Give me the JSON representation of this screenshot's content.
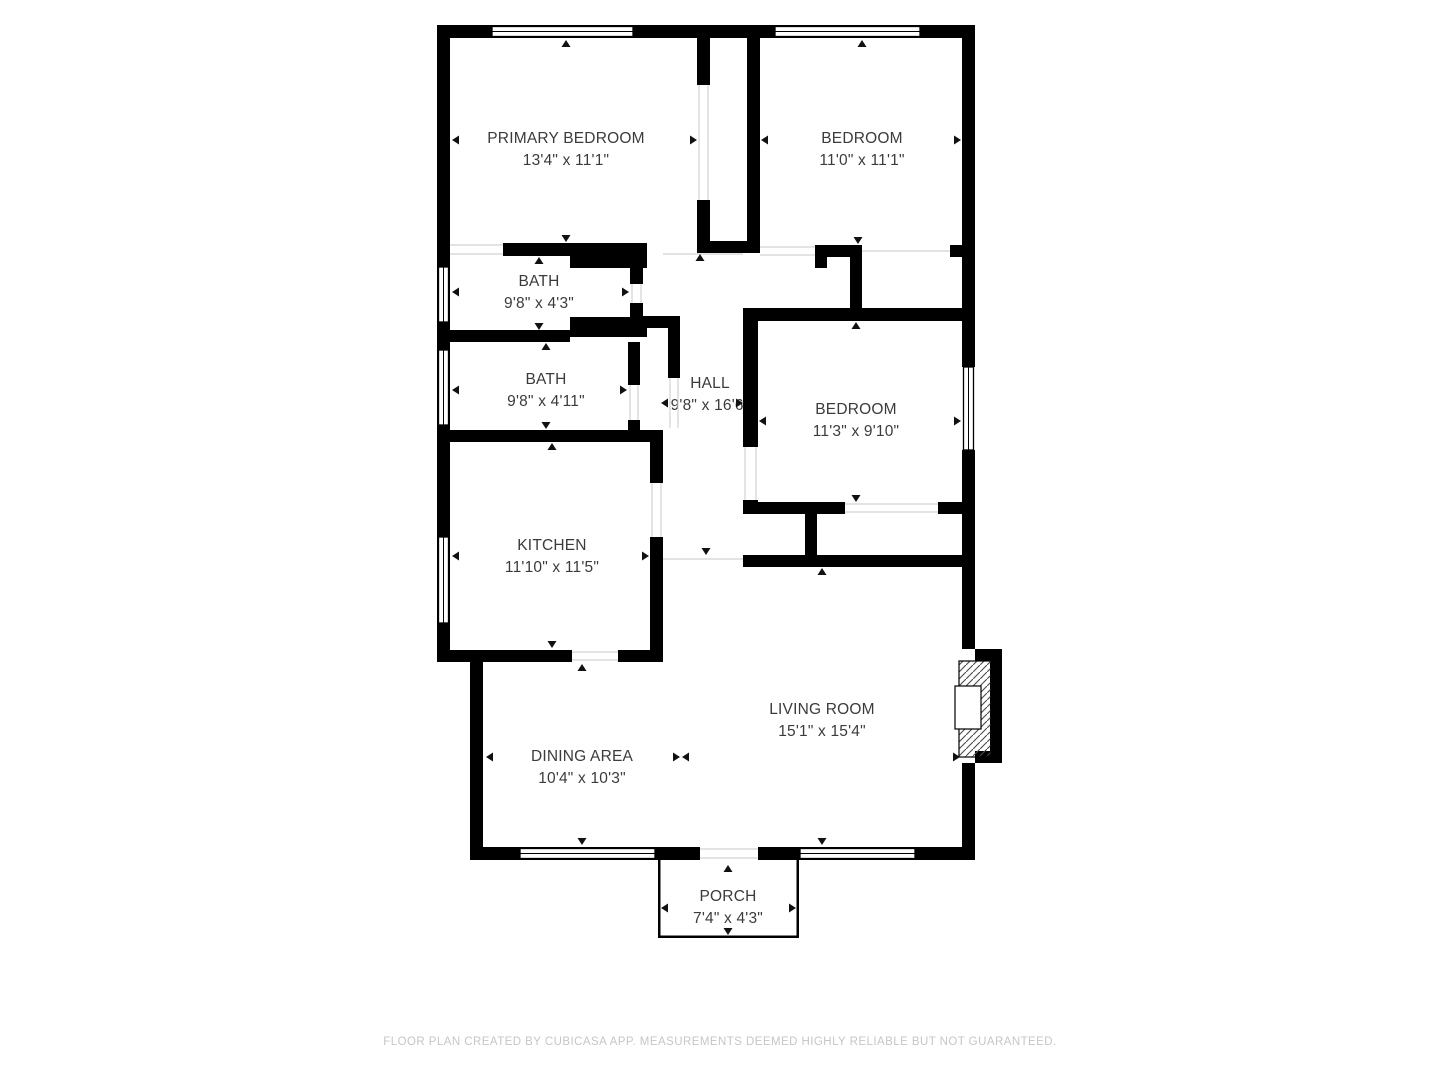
{
  "title": "Floor plan",
  "colors": {
    "wall": "#000000",
    "label_text": "#3b3b3b",
    "footer_text": "#c6c6c6",
    "background": "#ffffff",
    "open_boundary_line": "#d2d2d2"
  },
  "rooms": [
    {
      "id": "primary-bedroom",
      "name": "PRIMARY BEDROOM",
      "dims": "13'4\" x 11'1\""
    },
    {
      "id": "bedroom-top-right",
      "name": "BEDROOM",
      "dims": "11'0\" x 11'1\""
    },
    {
      "id": "bath-upper",
      "name": "BATH",
      "dims": "9'8\" x 4'3\""
    },
    {
      "id": "bath-lower",
      "name": "BATH",
      "dims": "9'8\" x 4'11\""
    },
    {
      "id": "hall",
      "name": "HALL",
      "dims": "9'8\" x 16'6\""
    },
    {
      "id": "bedroom-middle",
      "name": "BEDROOM",
      "dims": "11'3\" x 9'10\""
    },
    {
      "id": "kitchen",
      "name": "KITCHEN",
      "dims": "11'10\" x 11'5\""
    },
    {
      "id": "dining-area",
      "name": "DINING AREA",
      "dims": "10'4\" x 10'3\""
    },
    {
      "id": "living-room",
      "name": "LIVING ROOM",
      "dims": "15'1\" x 15'4\""
    },
    {
      "id": "porch",
      "name": "PORCH",
      "dims": "7'4\" x 4'3\""
    }
  ],
  "footer": {
    "text": "FLOOR PLAN CREATED BY CUBICASA APP. MEASUREMENTS DEEMED HIGHLY RELIABLE BUT NOT GUARANTEED."
  }
}
